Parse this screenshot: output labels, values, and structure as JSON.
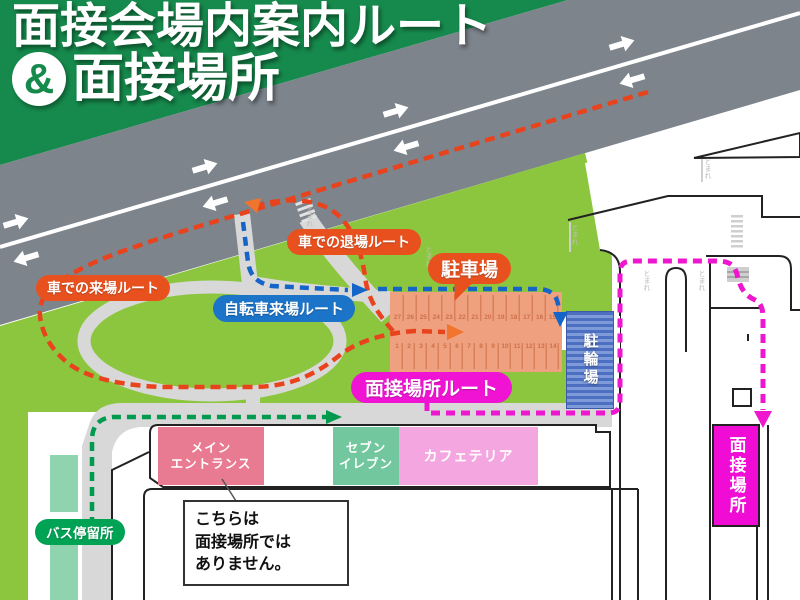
{
  "title": {
    "line1": "面接会場内案内ルート",
    "amp": "&",
    "line2": "面接場所"
  },
  "labels": {
    "car_arrival": "車での来場ルート",
    "car_exit": "車での退場ルート",
    "bicycle": "自転車来場ルート",
    "parking": "駐車場",
    "interview_route": "面接場所ルート",
    "bus_stop": "バス停留所",
    "bicycle_parking": "駐輪場",
    "interview_place": "面接場所"
  },
  "buildings": {
    "main_entrance": {
      "line1": "メイン",
      "line2": "エントランス"
    },
    "seven_eleven": {
      "line1": "セブン",
      "line2": "イレブン"
    },
    "cafeteria": "カフェテリア"
  },
  "notice": {
    "line1": "こちらは",
    "line2": "面接場所では",
    "line3": "ありません。"
  },
  "parking": {
    "stalls_top": [
      "27",
      "26",
      "25",
      "24",
      "23",
      "22",
      "21",
      "20",
      "19",
      "18",
      "17",
      "16",
      "15"
    ],
    "stalls_bottom": [
      "1",
      "2",
      "3",
      "4",
      "5",
      "6",
      "7",
      "8",
      "9",
      "10",
      "11",
      "12",
      "13",
      "14"
    ]
  },
  "road_markings": {
    "text": "とまれ",
    "positions": [
      {
        "x": 306,
        "y": 206
      },
      {
        "x": 425,
        "y": 246
      },
      {
        "x": 571,
        "y": 224
      },
      {
        "x": 643,
        "y": 270
      },
      {
        "x": 698,
        "y": 270
      },
      {
        "x": 704,
        "y": 158
      }
    ]
  },
  "colors": {
    "title_green": "#168a4c",
    "road_gray": "#7d848c",
    "grass": "#8cc63f",
    "path_gray": "#d8d8d8",
    "route_car": "#e8431c",
    "route_car_arrow": "#f0742e",
    "route_bicycle": "#1565c8",
    "route_walk": "#009a4e",
    "route_interview": "#ee17cf",
    "label_orange": "#e8511e",
    "label_blue": "#1b74c8",
    "label_magenta": "#f013d3",
    "bus_green": "#00a254",
    "bus_platform_mint": "#8fd4ae",
    "building_pink": "#e87a92",
    "building_mint": "#72c79e",
    "building_lightpink": "#f4a6e0",
    "parking_fill": "#efa07e",
    "parking_line": "#d9805a",
    "bicycle_parking_blue": "#4d6fc2"
  }
}
